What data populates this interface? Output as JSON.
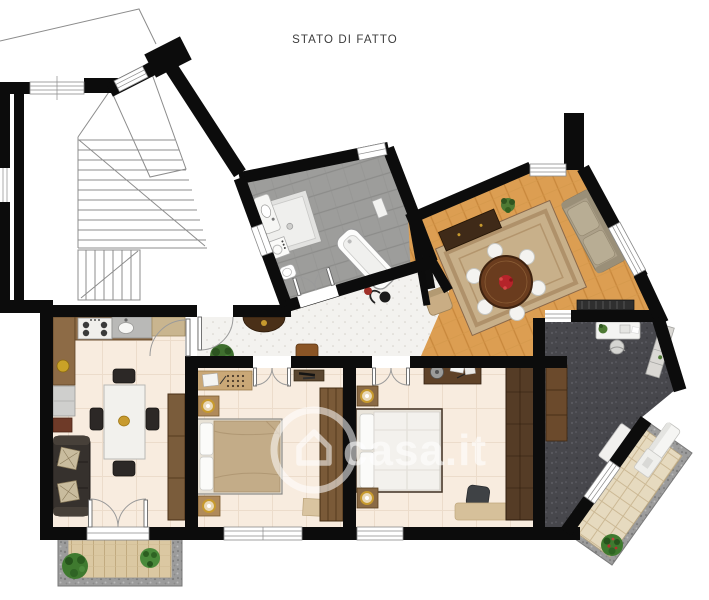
{
  "title": "STATO DI FATTO",
  "watermark": {
    "text": "casa.it",
    "icon": "house-circle-icon"
  },
  "colors": {
    "wall": "#0c0c0c",
    "floor_cream": "#f8ecdf",
    "floor_parquet": "#dc9e52",
    "floor_bath": "#9d9d9b",
    "floor_hall": "#f3f2ef",
    "floor_study": "#47474c",
    "terrace_tile": "#e6dabf",
    "balcony_deck": "#dbc8a2",
    "gravel": "#9c9c9c",
    "accent_red": "#b5242a",
    "wood_dark": "#4a3018",
    "wood_mid": "#8a6a45",
    "sofa_dark": "#36312d",
    "bed_tan": "#c3ac88",
    "plant_green": "#3f7a2f"
  },
  "rooms": [
    {
      "id": "staircase"
    },
    {
      "id": "kitchen-living"
    },
    {
      "id": "hallway"
    },
    {
      "id": "bathroom"
    },
    {
      "id": "living-room"
    },
    {
      "id": "bedroom-1"
    },
    {
      "id": "bedroom-2"
    },
    {
      "id": "study"
    },
    {
      "id": "balcony"
    },
    {
      "id": "terrace"
    }
  ],
  "furniture": {
    "kitchen_living": [
      "kitchen-counter",
      "stove",
      "kitchen-sink",
      "fridge",
      "sofa",
      "dining-table",
      "chairs",
      "wardrobe"
    ],
    "bathroom": [
      "shower",
      "washbasin",
      "washing-machine",
      "toilet",
      "bathtub",
      "radiator"
    ],
    "living_room": [
      "rug",
      "round-table",
      "dining-chairs",
      "sofa",
      "sideboard",
      "tv",
      "armchair",
      "radiator",
      "plant"
    ],
    "bedroom_1": [
      "desk",
      "double-bed",
      "nightstands",
      "wardrobe"
    ],
    "bedroom_2": [
      "dresser",
      "double-bed",
      "nightstands",
      "wardrobe",
      "pouf",
      "rug"
    ],
    "study": [
      "desk",
      "office-chair",
      "shelf",
      "cabinet",
      "tv"
    ],
    "terrace": [
      "bench",
      "table",
      "plant"
    ],
    "balcony": [
      "plants"
    ]
  }
}
